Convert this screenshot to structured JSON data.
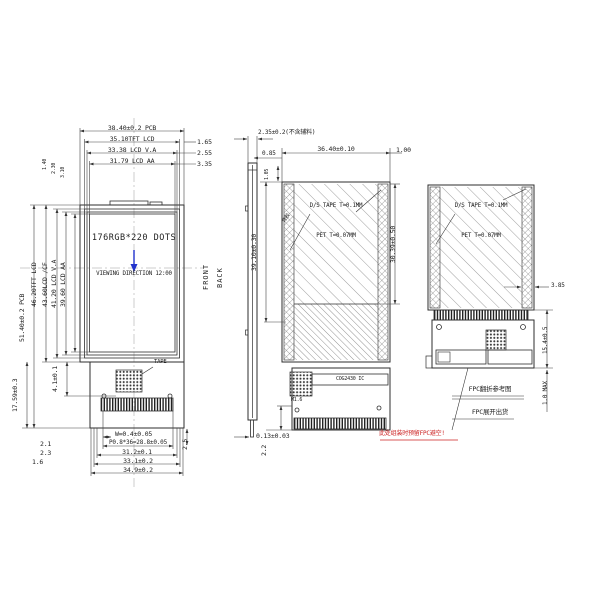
{
  "colors": {
    "line": "#333333",
    "viewing_arrow": "#2233cc",
    "warning": "#cc2222"
  },
  "front_view": {
    "width_dims": {
      "pcb": "38.40±0.2 PCB",
      "tft": "35.10TFT LCD",
      "va": "33.38 LCD V.A",
      "aa": "31.79 LCD AA"
    },
    "width_offsets": {
      "tft": "1.65",
      "va": "2.55",
      "aa": "3.35"
    },
    "height_dims": {
      "pcb": "51.40±0.2 PCB",
      "tft": "46.20TFT LCD",
      "cf": "43.60LCD /CF",
      "va": "41.20 LCD V.A",
      "aa": "39.60 LCD AA"
    },
    "corner_offsets": {
      "a": "1.40",
      "b": "2.30",
      "c": "3.10"
    },
    "display_text": "176RGB*220 DOTS",
    "viewing_text": "VIEWING DIRECTION 12:00",
    "tape_label": "TAPE",
    "bottom_dims": {
      "tape_h": "4.1±0.1",
      "fpc_h": "17.59±0.3",
      "pin_w": "W=0.4±0.05",
      "pitch": "P0.8*36=28.8±0.05",
      "d1": "31.2±0.1",
      "d2": "33.1±0.2",
      "d3": "34.9±0.2",
      "o1": "2.1",
      "o2": "2.3",
      "o3": "1.6",
      "pin_h": "2.5"
    }
  },
  "side_view": {
    "thickness": "2.35±0.2(不含辅料)",
    "glass": "0.85",
    "front_label": "FRONT",
    "back_label": "BACK",
    "fpc_t": "0.13±0.03"
  },
  "back_view_a": {
    "width": "36.40±0.10",
    "edge": "1.00",
    "top_offset": "1.05",
    "height": "39.10±0.30",
    "tape_height": "30.39±0.50",
    "tape_text": "D/S TAPE T=0.1MM",
    "pet_text": "PET T=0.07MM",
    "adhesive_label": "背胶",
    "ic_label": "COG2430 IC",
    "hole_label": "M1.6",
    "bottom_offset": "2.2"
  },
  "back_view_b": {
    "tape_text": "D/S TAPE T=0.1MM",
    "pet_text": "PET T=0.07MM",
    "edge_width": "3.85",
    "fold_height": "15.4±0.5",
    "fold_gap": "1.0 MAX",
    "note_fold": "FPC翻折参考图",
    "note_ship": "FPC展开出货"
  },
  "annotations": {
    "warning": "此处组装时预留FPC避空!"
  }
}
